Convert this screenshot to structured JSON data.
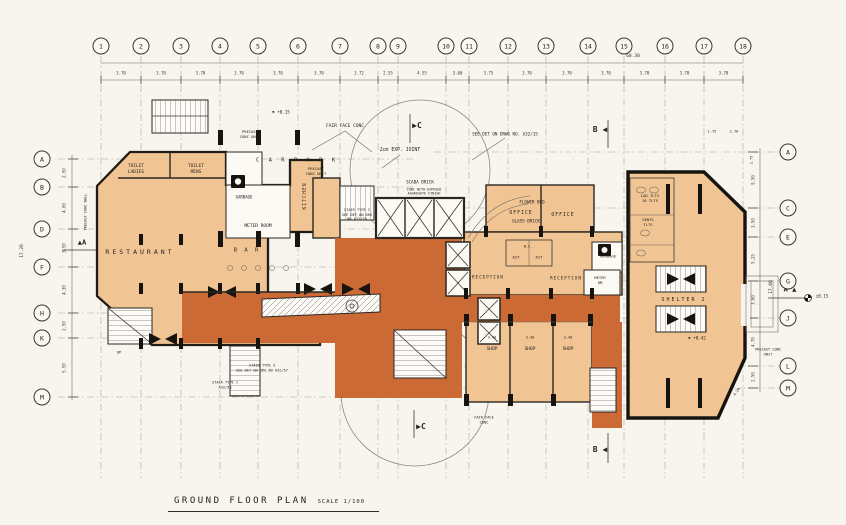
{
  "title": {
    "name": "GROUND FLOOR PLAN",
    "scale": "SCALE 1/100"
  },
  "colors": {
    "paper": "#f7f5ee",
    "plan_fill": "#f1c493",
    "lobby_fill": "#cc6a36",
    "ink": "#2a2620",
    "grid": "#a8a296"
  },
  "grid": {
    "bubble_y": 46,
    "columns": [
      {
        "label": "1",
        "x": 101
      },
      {
        "label": "2",
        "x": 141
      },
      {
        "label": "3",
        "x": 181
      },
      {
        "label": "4",
        "x": 220
      },
      {
        "label": "5",
        "x": 258
      },
      {
        "label": "6",
        "x": 298
      },
      {
        "label": "7",
        "x": 340
      },
      {
        "label": "8",
        "x": 378
      },
      {
        "label": "9",
        "x": 398
      },
      {
        "label": "10",
        "x": 446
      },
      {
        "label": "11",
        "x": 469
      },
      {
        "label": "12",
        "x": 508
      },
      {
        "label": "13",
        "x": 546
      },
      {
        "label": "14",
        "x": 588
      },
      {
        "label": "15",
        "x": 624
      },
      {
        "label": "16",
        "x": 665
      },
      {
        "label": "17",
        "x": 704
      },
      {
        "label": "18",
        "x": 743
      }
    ],
    "column_dims": [
      "3.70",
      "3.70",
      "3.70",
      "3.70",
      "3.70",
      "3.70",
      "3.72",
      "2.55",
      "4.55",
      "3.60",
      "3.75",
      "3.70",
      "3.70",
      "3.70",
      "3.70",
      "3.70",
      "3.70"
    ],
    "total_width": "60.30",
    "rows_left": [
      {
        "label": "A",
        "y": 159
      },
      {
        "label": "B",
        "y": 187
      },
      {
        "label": "D",
        "y": 229
      },
      {
        "label": "F",
        "y": 267
      },
      {
        "label": "H",
        "y": 313
      },
      {
        "label": "K",
        "y": 338
      },
      {
        "label": "M",
        "y": 397
      }
    ],
    "rows_left_x": 42,
    "left_dims": [
      "2.50",
      "4.00",
      "3.50",
      "4.30",
      "2.50",
      "5.50"
    ],
    "left_total": "17.20",
    "rows_right": [
      {
        "label": "A",
        "y": 152
      },
      {
        "label": "C",
        "y": 208
      },
      {
        "label": "E",
        "y": 237
      },
      {
        "label": "G",
        "y": 281
      },
      {
        "label": "J",
        "y": 318
      },
      {
        "label": "L",
        "y": 366
      },
      {
        "label": "M",
        "y": 388
      }
    ],
    "rows_right_x": 788,
    "right_dims": [
      "9.50",
      "3.50",
      "5.25",
      "3.60",
      "4.70",
      "2.50"
    ],
    "right_total": "17.00"
  },
  "labels": [
    {
      "name": "label-car-park",
      "text": "C A R     P A R K",
      "x": 297,
      "y": 161,
      "s": 5.5,
      "ls": 3
    },
    {
      "name": "label-toilet-ladies",
      "text": "TOILET\nLADIES",
      "x": 136,
      "y": 170,
      "s": 4.5
    },
    {
      "name": "label-toilet-mens",
      "text": "TOILET\nMENS",
      "x": 196,
      "y": 170,
      "s": 4.5
    },
    {
      "name": "label-kitchen",
      "text": "KITCHEN",
      "x": 306,
      "y": 196,
      "s": 4.8,
      "rot": -90,
      "ls": 1
    },
    {
      "name": "label-garbage-left",
      "text": "GARBAGE",
      "x": 244,
      "y": 197,
      "s": 4
    },
    {
      "name": "label-meter-room",
      "text": "METER  ROOM",
      "x": 258,
      "y": 227,
      "s": 4.5
    },
    {
      "name": "label-restaurant",
      "text": "RESTAURANT",
      "x": 140,
      "y": 252,
      "s": 6.5,
      "ls": 3
    },
    {
      "name": "label-bar",
      "text": "B A R",
      "x": 247,
      "y": 251,
      "s": 5.5,
      "ls": 2
    },
    {
      "name": "label-exp-joint",
      "text": "2cm EXP. JOINT",
      "x": 400,
      "y": 151,
      "s": 4.8
    },
    {
      "name": "label-fair-face-conc-top",
      "text": "FAIR FACE CONC",
      "x": 345,
      "y": 127,
      "s": 4.5
    },
    {
      "name": "label-precast-conc-top",
      "text": "PRECAST\nCONC UNIT",
      "x": 250,
      "y": 135,
      "s": 3.8
    },
    {
      "name": "label-precast-conc-top2",
      "text": "PRECAST\nCONC UNIT",
      "x": 316,
      "y": 172,
      "s": 3.8
    },
    {
      "name": "label-scaba-brick",
      "text": "SCABA  BRICK",
      "x": 420,
      "y": 182,
      "s": 4.2
    },
    {
      "name": "label-exposed-aggregate",
      "text": "CONC WITH EXPOSED\nAGGREGATE FINISH",
      "x": 424,
      "y": 192,
      "s": 3.4
    },
    {
      "name": "label-flower-bed",
      "text": "FLOWER BED",
      "x": 532,
      "y": 202,
      "s": 4.2
    },
    {
      "name": "label-glass-brick",
      "text": "GLASS  BRICK",
      "x": 526,
      "y": 221,
      "s": 4.2
    },
    {
      "name": "label-see-det-note",
      "text": "SEE DET ON DRWG NO.  A32/15",
      "x": 505,
      "y": 134,
      "s": 4.2
    },
    {
      "name": "label-office-1",
      "text": "OFFICE",
      "x": 521,
      "y": 214,
      "s": 4.8,
      "ls": 1
    },
    {
      "name": "label-office-2",
      "text": "OFFICE",
      "x": 563,
      "y": 216,
      "s": 4.8,
      "ls": 1
    },
    {
      "name": "label-stair-type2-note",
      "text": "STAIR TYPE 2\nSEE DET ON DRG\nNO A32/59",
      "x": 357,
      "y": 215,
      "s": 3.6
    },
    {
      "name": "label-lad-tlts",
      "text": "LAD TLTS\n10 TLTS",
      "x": 650,
      "y": 199,
      "s": 3.8
    },
    {
      "name": "label-gents-tlts",
      "text": "GENTS\nTLTS",
      "x": 648,
      "y": 223,
      "s": 3.8
    },
    {
      "name": "label-garbage-right",
      "text": "GARBAGE",
      "x": 608,
      "y": 257,
      "s": 3.8
    },
    {
      "name": "label-meter-rm",
      "text": "METER\nRM",
      "x": 600,
      "y": 281,
      "s": 3.8
    },
    {
      "name": "label-reception-1",
      "text": "RECEPTION",
      "x": 488,
      "y": 277,
      "s": 4.2,
      "ls": 1
    },
    {
      "name": "label-reception-2",
      "text": "RECEPTION",
      "x": 566,
      "y": 278,
      "s": 4.2,
      "ls": 1
    },
    {
      "name": "label-kit-1",
      "text": "KIT",
      "x": 516,
      "y": 258,
      "s": 3.8
    },
    {
      "name": "label-kit-2",
      "text": "KIT",
      "x": 539,
      "y": 258,
      "s": 3.8
    },
    {
      "name": "label-wc",
      "text": "W.C.",
      "x": 528,
      "y": 247,
      "s": 3.5
    },
    {
      "name": "label-shelter",
      "text": "SHELTER 2",
      "x": 684,
      "y": 300,
      "s": 5,
      "ls": 2
    },
    {
      "name": "label-shop-1",
      "text": "SHOP",
      "x": 492,
      "y": 350,
      "s": 4.5
    },
    {
      "name": "label-shop-2",
      "text": "SHOP",
      "x": 530,
      "y": 350,
      "s": 4.5
    },
    {
      "name": "label-shop-3",
      "text": "SHOP",
      "x": 568,
      "y": 350,
      "s": 4.5
    },
    {
      "name": "label-shop-dim-1",
      "text": "3.40",
      "x": 492,
      "y": 338,
      "s": 3.5
    },
    {
      "name": "label-shop-dim-2",
      "text": "3.40",
      "x": 530,
      "y": 338,
      "s": 3.5
    },
    {
      "name": "label-shop-dim-3",
      "text": "3.40",
      "x": 568,
      "y": 338,
      "s": 3.5
    },
    {
      "name": "label-stair-type3-note",
      "text": "STAIR TYPE 3\nSEE DET ON DRG NO A32/57",
      "x": 262,
      "y": 368,
      "s": 3.6
    },
    {
      "name": "label-stair-type1-note",
      "text": "STAIR TYPE 1\nA32/58",
      "x": 225,
      "y": 385,
      "s": 3.6
    },
    {
      "name": "label-fair-face-conc-bottom",
      "text": "FAIR FACE\nCONC",
      "x": 484,
      "y": 420,
      "s": 3.6
    },
    {
      "name": "label-precast-conc-wall-left",
      "text": "PRECAST CONC WALL",
      "x": 86,
      "y": 212,
      "s": 3.6,
      "rot": -90
    },
    {
      "name": "label-precast-conc-right",
      "text": "PRECAST CONC\nUNIT",
      "x": 768,
      "y": 352,
      "s": 3.6
    },
    {
      "name": "section-marker-c-top",
      "text": "▶C",
      "x": 417,
      "y": 126,
      "s": 8,
      "b": 1
    },
    {
      "name": "section-marker-c-bottom",
      "text": "▶C",
      "x": 421,
      "y": 427,
      "s": 8,
      "b": 1
    },
    {
      "name": "section-marker-b-top",
      "text": "B ◀",
      "x": 600,
      "y": 130,
      "s": 8,
      "b": 1
    },
    {
      "name": "section-marker-b-bottom",
      "text": "B ◀",
      "x": 600,
      "y": 450,
      "s": 8,
      "b": 1
    },
    {
      "name": "section-marker-a-left",
      "text": "▲A",
      "x": 82,
      "y": 243,
      "s": 7,
      "b": 1
    },
    {
      "name": "section-marker-a-right",
      "text": "A ▲",
      "x": 790,
      "y": 290,
      "s": 7,
      "b": 1
    },
    {
      "name": "level-marker-1",
      "text": "⚑ +0.15",
      "x": 281,
      "y": 112,
      "s": 4.2
    },
    {
      "name": "level-marker-2",
      "text": "⚑ +0.42",
      "x": 697,
      "y": 338,
      "s": 4.2
    },
    {
      "name": "level-marker-3",
      "text": "±0.15",
      "x": 822,
      "y": 296,
      "s": 4.2
    },
    {
      "name": "dim-1-75",
      "text": "1.75",
      "x": 712,
      "y": 132,
      "s": 3.6
    },
    {
      "name": "dim-2-70",
      "text": "2.70",
      "x": 734,
      "y": 132,
      "s": 3.6
    },
    {
      "name": "dim-4-20",
      "text": "4.20",
      "x": 737,
      "y": 392,
      "s": 3.6,
      "rot": -55
    },
    {
      "name": "dim-2-75",
      "text": "2.75",
      "x": 752,
      "y": 160,
      "s": 3.5,
      "rot": -90
    },
    {
      "name": "label-up",
      "text": "UP",
      "x": 119,
      "y": 353,
      "s": 3.8
    }
  ]
}
